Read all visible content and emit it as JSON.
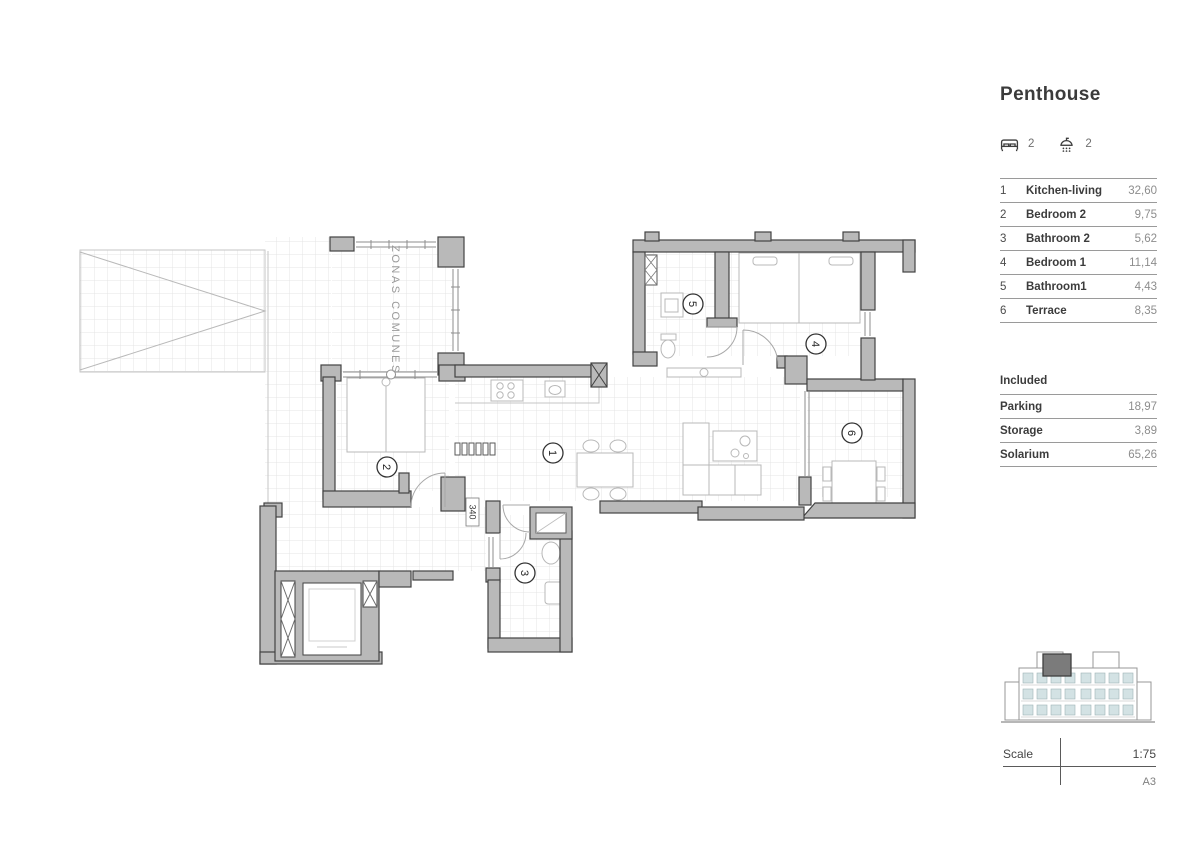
{
  "panel": {
    "title": "Penthouse",
    "features": {
      "bedrooms": "2",
      "bathrooms": "2"
    },
    "rooms": [
      {
        "num": "1",
        "name": "Kitchen-living",
        "area": "32,60"
      },
      {
        "num": "2",
        "name": "Bedroom 2",
        "area": "9,75"
      },
      {
        "num": "3",
        "name": "Bathroom 2",
        "area": "5,62"
      },
      {
        "num": "4",
        "name": "Bedroom 1",
        "area": "11,14"
      },
      {
        "num": "5",
        "name": "Bathroom1",
        "area": "4,43"
      },
      {
        "num": "6",
        "name": "Terrace",
        "area": "8,35"
      }
    ],
    "included": {
      "heading": "Included",
      "items": [
        {
          "name": "Parking",
          "area": "18,97"
        },
        {
          "name": "Storage",
          "area": "3,89"
        },
        {
          "name": "Solarium",
          "area": "65,26"
        }
      ]
    },
    "scale": {
      "label": "Scale",
      "value": "1:75",
      "sheet": "A3"
    }
  },
  "plan": {
    "zonas_comunes_label": "ZONAS COMUNES",
    "dimension_label": "340"
  },
  "colors": {
    "wall": "#b9b9b9",
    "glass": "#d3e2e4",
    "highlight": "#7b7b7b"
  }
}
